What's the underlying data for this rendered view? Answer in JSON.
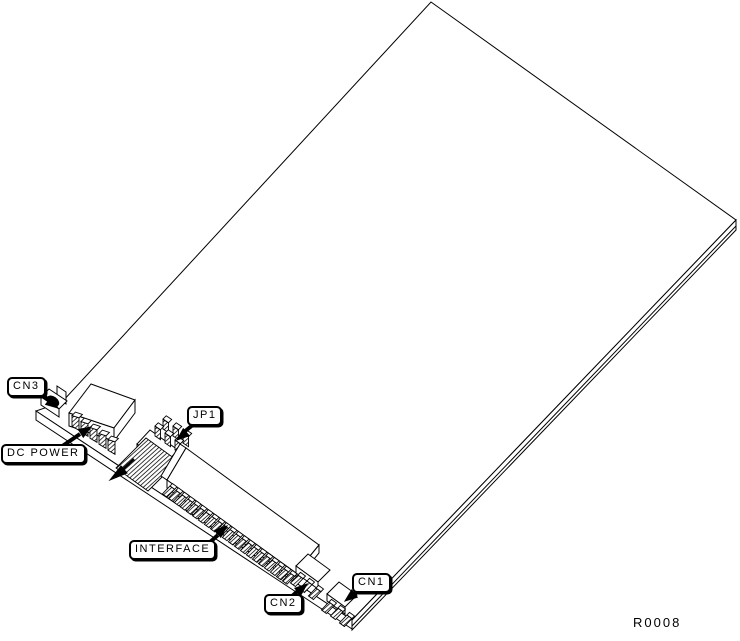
{
  "figure": {
    "type": "hardware-isometric-diagram",
    "description": "Line drawing of a controller card shown at an angle with connectors along the lower-left edge",
    "figure_ref": "R0008",
    "colors": {
      "background": "#ffffff",
      "line": "#000000",
      "label_background": "#ffffff",
      "label_text": "#000000"
    },
    "callouts": [
      {
        "id": "cn3",
        "label": "CN3"
      },
      {
        "id": "dc_power",
        "label": "DC POWER"
      },
      {
        "id": "jp1",
        "label": "JP1"
      },
      {
        "id": "interface",
        "label": "INTERFACE"
      },
      {
        "id": "cn2",
        "label": "CN2"
      },
      {
        "id": "cn1",
        "label": "CN1"
      }
    ]
  }
}
